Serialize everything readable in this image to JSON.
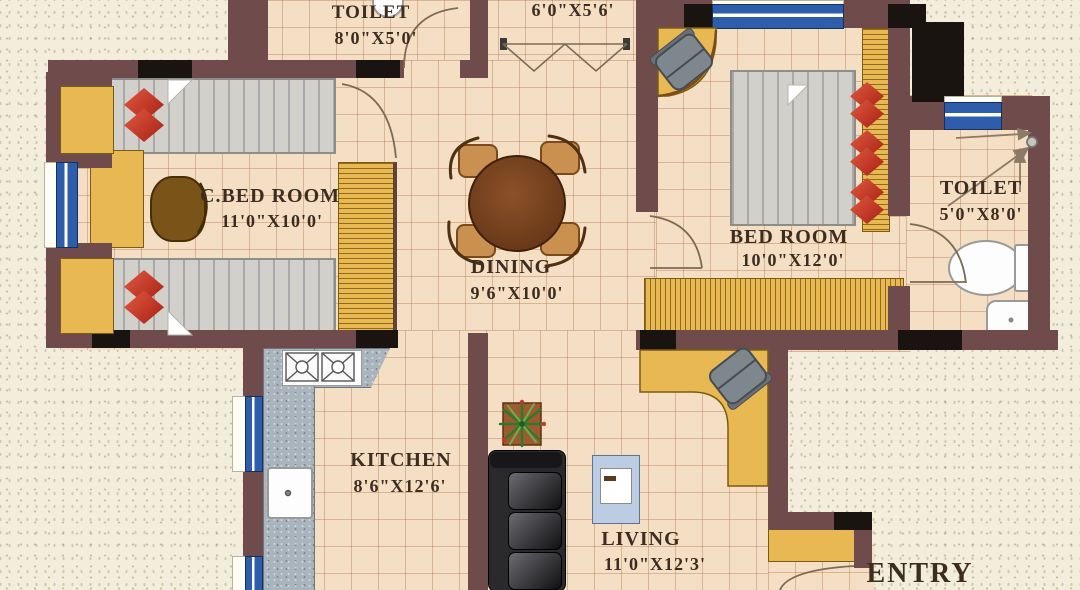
{
  "plan": {
    "type": "apartment-floor-plan",
    "rooms": [
      {
        "id": "toilet-top",
        "name": "TOILET",
        "dims": "8'0\"X5'0'"
      },
      {
        "id": "store",
        "name": "",
        "dims": "6'0\"X5'6'"
      },
      {
        "id": "c-bed-room",
        "name": "C.BED ROOM",
        "dims": "11'0\"X10'0'"
      },
      {
        "id": "dining",
        "name": "DINING",
        "dims": "9'6\"X10'0'"
      },
      {
        "id": "bed-room",
        "name": "BED ROOM",
        "dims": "10'0\"X12'0'"
      },
      {
        "id": "toilet-right",
        "name": "TOILET",
        "dims": "5'0\"X8'0'"
      },
      {
        "id": "kitchen",
        "name": "KITCHEN",
        "dims": "8'6\"X12'6'"
      },
      {
        "id": "living",
        "name": "LIVING",
        "dims": "11'0\"X12'3'"
      },
      {
        "id": "entry",
        "name": "ENTRY",
        "dims": ""
      }
    ],
    "furniture": [
      {
        "item": "single-bed",
        "room": "c-bed-room",
        "count": 2
      },
      {
        "item": "study-desk-with-stool",
        "room": "c-bed-room"
      },
      {
        "item": "wardrobe",
        "room": "c-bed-room"
      },
      {
        "item": "window-seat-bay",
        "room": "c-bed-room",
        "count": 2
      },
      {
        "item": "round-dining-table-4-chairs",
        "room": "dining"
      },
      {
        "item": "double-bed",
        "room": "bed-room"
      },
      {
        "item": "wardrobe",
        "room": "bed-room",
        "count": 2
      },
      {
        "item": "corner-desk-with-chair",
        "room": "bed-room"
      },
      {
        "item": "l-shaped-counter-stove-sink",
        "room": "kitchen"
      },
      {
        "item": "sofa",
        "room": "living"
      },
      {
        "item": "center-table",
        "room": "living"
      },
      {
        "item": "potted-plant",
        "room": "living"
      },
      {
        "item": "study-desk-with-chair",
        "room": "living"
      },
      {
        "item": "shoe-cabinet",
        "room": "entry"
      },
      {
        "item": "wc-and-basin",
        "room": "toilet-right"
      },
      {
        "item": "wash-basin",
        "room": "toilet-top"
      },
      {
        "item": "folding-wardrobe",
        "room": "store"
      }
    ],
    "colors": {
      "wall": "#6f4b4b",
      "wall_accent": "#1a1410",
      "window": "#2e5dac",
      "floor_tile": "#f4dfc4",
      "outside": "#f2eedb",
      "wood": "#e8b852",
      "counter": "#aab4bd",
      "sofa": "#232325",
      "pillow": "#c23428",
      "table_wood": "#6f3f1d",
      "label_text": "#3c2d20"
    }
  }
}
